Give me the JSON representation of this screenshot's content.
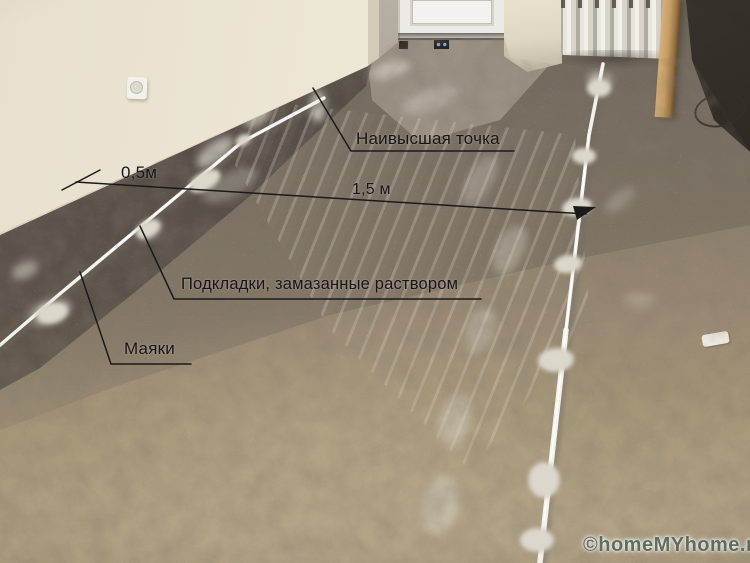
{
  "annotations": {
    "highest_point": "Наивысшая точка",
    "distance_wall_to_beacon": "0,5м",
    "distance_between_beacons": "1,5 м",
    "pads": "Подкладки, замазанные раствором",
    "beacons": "Маяки"
  },
  "watermark": {
    "text": "©homeMYhome.ru"
  },
  "colors": {
    "annotation_text": "#1a1a1a",
    "watermark_text": "#5f6f60",
    "wall": "#ece6d5",
    "floor_far": "#7b7063",
    "floor_near": "#a79878",
    "beacon_rail": "#f2f2ec",
    "mortar_pad": "#dbd7ca"
  }
}
